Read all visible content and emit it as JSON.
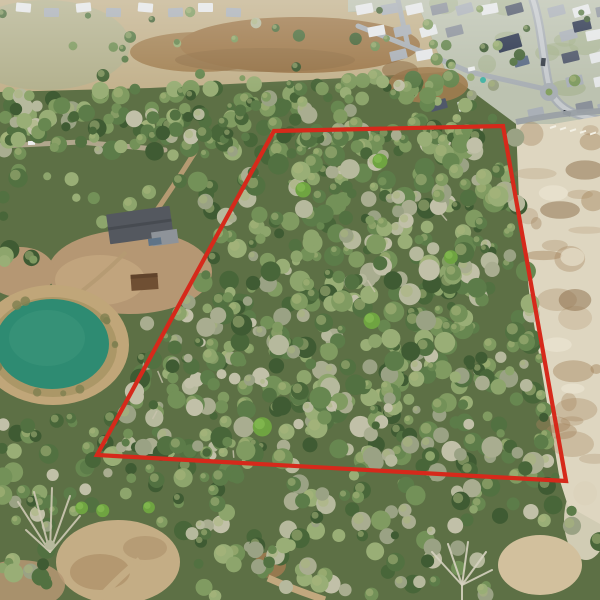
{
  "image": {
    "alt": "Aerial view of wooded land parcel outlined in red",
    "description": "Drone aerial photograph of a large wooded vacant-land parcel marked with a red quadrilateral boundary line. A residential subdivision with curving streets and a cul-de-sac sits at top right, an open tan and brown pasture at top center, a homestead with a dark gray roof and a small teal pond at left, freshly cleared white sandy ground along the right side, and continuing tree canopy below the parcel.",
    "width": 600,
    "height": 600
  },
  "boundary": {
    "shape": "quadrilateral",
    "points": "274,131 503,126 566,481 97,455",
    "color": "#d6291b",
    "stroke_width": 4.2
  },
  "landmarks": {
    "parcel": "dense mixed tree canopy inside the red outline",
    "pond": "small teal pond at lower left",
    "homestead": "house with dark gray roof, shed and dirt clearing left of parcel",
    "subdivision": "single-family homes, curving streets, cul-de-sac and a backyard pool at top right",
    "pasture": "open tan and brown dirt field at top center",
    "cleared_lot": "graded white sandy construction ground on the right",
    "bottom_forest": "tree canopy with bare snags and dirt clearings below the parcel"
  },
  "palette": {
    "base_green": "#5d7045",
    "forest_greens": [
      "#3f5b33",
      "#486639",
      "#527141",
      "#5c7c49",
      "#678750",
      "#739158",
      "#809b61",
      "#8da56c",
      "#99ae76"
    ],
    "dead_canopy": [
      "#a9ad90",
      "#b6b99d",
      "#c1c0a8",
      "#9aa284"
    ],
    "canopy_highlight": "#a9b77b",
    "vivid_green": "#6fa441",
    "vivid_highlight": "#8cc258",
    "field_tan": "#c3b28d",
    "field_grass": "#b2b18f",
    "dirt_brown": "#a07c4f",
    "dirt_dark": "#8d6d45",
    "sand_light": "#ded6c0",
    "sand_brown": "#a3835c",
    "sand_pale": "#ece6d4",
    "subdivision_base": "#bcc2b0",
    "lawn_green": "#9fae85",
    "road_gray": "#a9afb4",
    "road_light": "#c6cacd",
    "water_teal": "#2e8b72",
    "water_light": "#3a9379",
    "bank_tan": "#c0a679",
    "bank_ring": "#a3915f",
    "clearing_tan": "#b59773",
    "path_tan": "#b59a72",
    "roof_white": "#e4e6e7",
    "roof_gray": "#aab0b7",
    "roof_dark": "#8b919a",
    "roof_slate": "#50586a",
    "roof_navy": "#2e3850",
    "roof_blue": "#5a6b85",
    "pool_teal": "#43b3a4",
    "homestead_roof": "#54585f",
    "shed_brown": "#6f4f33",
    "snag_gray": "#cfc9b4",
    "boundary_red": "#d6291b"
  }
}
